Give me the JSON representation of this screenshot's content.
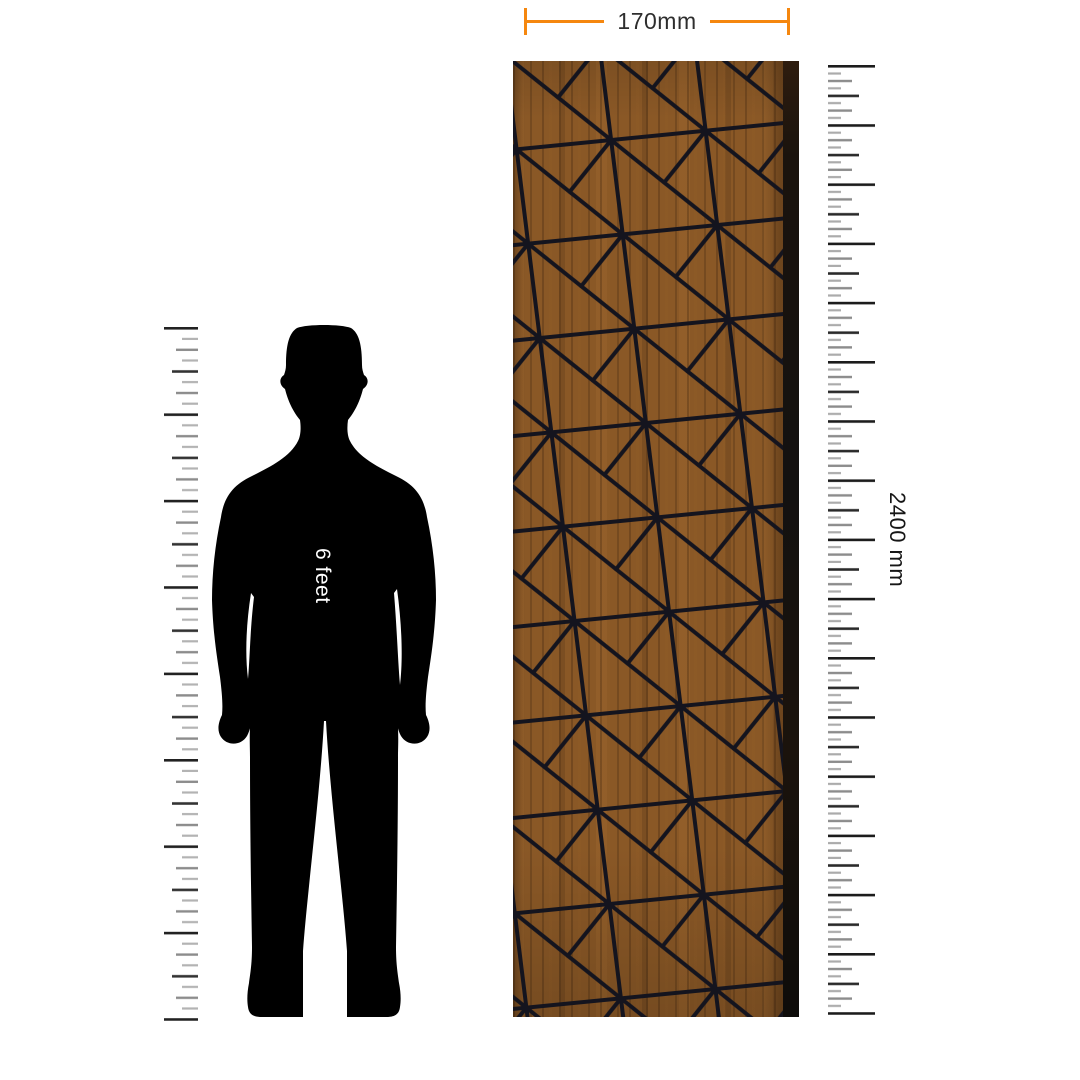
{
  "scene": {
    "description": "Wood wall panel size illustration with human silhouette for scale",
    "background": "#FFFFFF"
  },
  "labels": {
    "panel_width": "170mm",
    "panel_height": "2400 mm",
    "figure_height": "6 feet"
  },
  "colors": {
    "dimension_accent": "#F5870F",
    "dimension_text": "#2E2E2E",
    "wood_base": "#8A5826",
    "pattern_line": "#14141E",
    "panel_edge_shadow": "#131110",
    "silhouette": "#000000",
    "figure_label_text": "#FFFFFF",
    "height_label_text": "#161616",
    "ruler_tick_dark": "#1C1C1C",
    "ruler_tick_medium": "#8C8C8C",
    "ruler_tick_light": "#ABABAB"
  }
}
